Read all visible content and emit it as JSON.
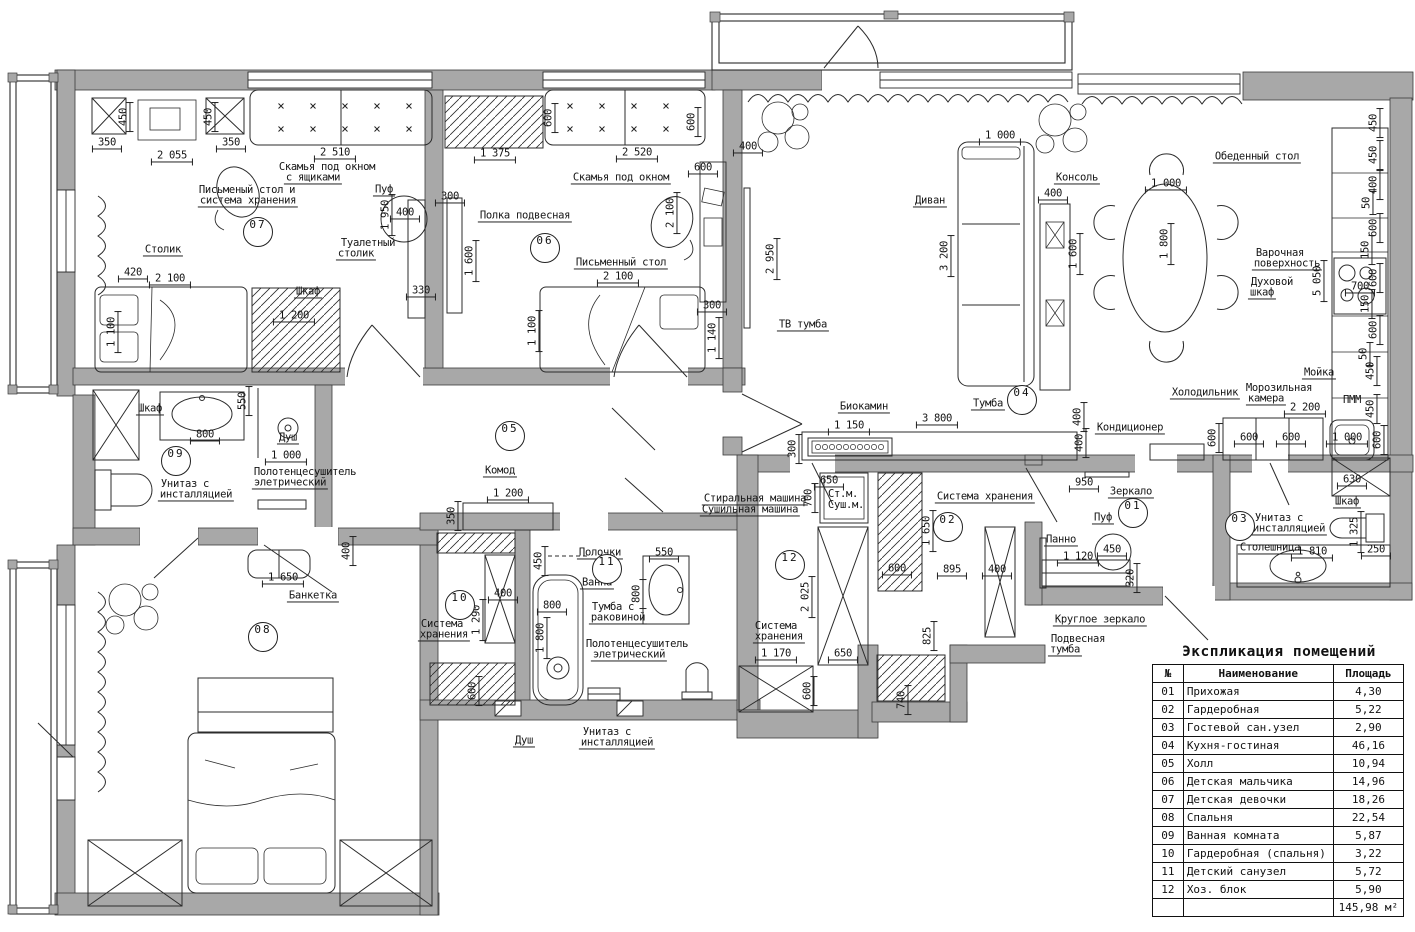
{
  "colors": {
    "wall": "#a8a8a8",
    "line": "#222222",
    "background": "#ffffff"
  },
  "legend": {
    "title": "Экспликация помещений",
    "col_no": "№",
    "col_name": "Наименование",
    "col_area": "Площадь",
    "rows": [
      [
        "01",
        "Прихожая",
        "4,30"
      ],
      [
        "02",
        "Гардеробная",
        "5,22"
      ],
      [
        "03",
        "Гостевой сан.узел",
        "2,90"
      ],
      [
        "04",
        "Кухня-гостиная",
        "46,16"
      ],
      [
        "05",
        "Холл",
        "10,94"
      ],
      [
        "06",
        "Детская мальчика",
        "14,96"
      ],
      [
        "07",
        "Детская девочки",
        "18,26"
      ],
      [
        "08",
        "Спальня",
        "22,54"
      ],
      [
        "09",
        "Ванная комната",
        "5,87"
      ],
      [
        "10",
        "Гардеробная (спальня)",
        "3,22"
      ],
      [
        "11",
        "Детский санузел",
        "5,72"
      ],
      [
        "12",
        "Хоз. блок",
        "5,90"
      ]
    ],
    "total": "145,98 м²"
  },
  "rooms": [
    {
      "n": "07",
      "x": 258,
      "y": 232
    },
    {
      "n": "06",
      "x": 545,
      "y": 248
    },
    {
      "n": "04",
      "x": 1022,
      "y": 400
    },
    {
      "n": "05",
      "x": 510,
      "y": 436
    },
    {
      "n": "09",
      "x": 176,
      "y": 461
    },
    {
      "n": "08",
      "x": 263,
      "y": 637
    },
    {
      "n": "10",
      "x": 460,
      "y": 605
    },
    {
      "n": "11",
      "x": 607,
      "y": 569
    },
    {
      "n": "12",
      "x": 790,
      "y": 565
    },
    {
      "n": "02",
      "x": 948,
      "y": 527
    },
    {
      "n": "01",
      "x": 1133,
      "y": 513
    },
    {
      "n": "03",
      "x": 1240,
      "y": 526
    }
  ],
  "plan": {
    "labels": [
      {
        "t": "350",
        "x": 107,
        "y": 143,
        "d": 1
      },
      {
        "t": "2 055",
        "x": 172,
        "y": 156,
        "d": 1
      },
      {
        "t": "350",
        "x": 231,
        "y": 143,
        "d": 1
      },
      {
        "t": "2 510",
        "x": 335,
        "y": 153,
        "d": 1
      },
      {
        "t": "450",
        "x": 124,
        "y": 117,
        "d": 1,
        "r": -90
      },
      {
        "t": "450",
        "x": 209,
        "y": 117,
        "d": 1,
        "r": -90
      },
      {
        "t": "1 950",
        "x": 386,
        "y": 215,
        "d": 1,
        "r": -90
      },
      {
        "t": "400",
        "x": 405,
        "y": 213,
        "d": 1
      },
      {
        "t": "420",
        "x": 133,
        "y": 273,
        "d": 1
      },
      {
        "t": "2 100",
        "x": 170,
        "y": 279,
        "d": 1
      },
      {
        "t": "1 200",
        "x": 294,
        "y": 316,
        "d": 1
      },
      {
        "t": "330",
        "x": 421,
        "y": 291,
        "d": 1
      },
      {
        "t": "1 100",
        "x": 112,
        "y": 332,
        "d": 1,
        "r": -90
      },
      {
        "t": "Скамья под окном",
        "x": 327,
        "y": 167
      },
      {
        "t": "с ящиками",
        "x": 313,
        "y": 178,
        "u": 1
      },
      {
        "t": "Письменый стол и",
        "x": 247,
        "y": 190
      },
      {
        "t": "система хранения",
        "x": 248,
        "y": 201,
        "u": 1
      },
      {
        "t": "Пуф",
        "x": 384,
        "y": 190,
        "u": 1
      },
      {
        "t": "Туалетный",
        "x": 368,
        "y": 243
      },
      {
        "t": "столик",
        "x": 356,
        "y": 254,
        "u": 1
      },
      {
        "t": "Столик",
        "x": 163,
        "y": 250,
        "u": 1
      },
      {
        "t": "Шкаф",
        "x": 308,
        "y": 292,
        "u": 1
      },
      {
        "t": "600",
        "x": 549,
        "y": 118,
        "d": 1,
        "r": -90
      },
      {
        "t": "600",
        "x": 692,
        "y": 122,
        "d": 1,
        "r": -90
      },
      {
        "t": "1 375",
        "x": 495,
        "y": 154,
        "d": 1
      },
      {
        "t": "2 520",
        "x": 637,
        "y": 153,
        "d": 1
      },
      {
        "t": "600",
        "x": 703,
        "y": 168,
        "d": 1
      },
      {
        "t": "300",
        "x": 450,
        "y": 197,
        "d": 1
      },
      {
        "t": "2 100",
        "x": 671,
        "y": 213,
        "d": 1,
        "r": -90
      },
      {
        "t": "1 600",
        "x": 470,
        "y": 261,
        "d": 1,
        "r": -90
      },
      {
        "t": "2 100",
        "x": 618,
        "y": 277,
        "d": 1
      },
      {
        "t": "1 100",
        "x": 533,
        "y": 331,
        "d": 1,
        "r": -90
      },
      {
        "t": "300",
        "x": 712,
        "y": 306,
        "d": 1
      },
      {
        "t": "1 140",
        "x": 713,
        "y": 338,
        "d": 1,
        "r": -90
      },
      {
        "t": "Скамья под окном",
        "x": 621,
        "y": 178,
        "u": 1
      },
      {
        "t": "Полка подвесная",
        "x": 525,
        "y": 216,
        "u": 1
      },
      {
        "t": "Письменный стол",
        "x": 621,
        "y": 263,
        "u": 1
      },
      {
        "t": "400",
        "x": 748,
        "y": 147,
        "d": 1
      },
      {
        "t": "2 950",
        "x": 771,
        "y": 259,
        "d": 1,
        "r": -90
      },
      {
        "t": "1 000",
        "x": 1000,
        "y": 136,
        "d": 1
      },
      {
        "t": "3 200",
        "x": 945,
        "y": 256,
        "d": 1,
        "r": -90
      },
      {
        "t": "400",
        "x": 1053,
        "y": 194,
        "d": 1
      },
      {
        "t": "1 600",
        "x": 1074,
        "y": 254,
        "d": 1,
        "r": -90
      },
      {
        "t": "1 000",
        "x": 1166,
        "y": 184,
        "d": 1
      },
      {
        "t": "1 800",
        "x": 1165,
        "y": 244,
        "d": 1,
        "r": -90
      },
      {
        "t": "5 050",
        "x": 1318,
        "y": 281,
        "d": 1,
        "r": -90
      },
      {
        "t": "700",
        "x": 1360,
        "y": 287,
        "d": 1
      },
      {
        "t": "450",
        "x": 1374,
        "y": 123,
        "d": 1,
        "r": -90
      },
      {
        "t": "450",
        "x": 1374,
        "y": 155,
        "d": 1,
        "r": -90
      },
      {
        "t": "400",
        "x": 1374,
        "y": 185,
        "d": 1,
        "r": -90
      },
      {
        "t": "50",
        "x": 1367,
        "y": 203,
        "d": 1,
        "r": -90
      },
      {
        "t": "600",
        "x": 1374,
        "y": 228,
        "d": 1,
        "r": -90
      },
      {
        "t": "150",
        "x": 1366,
        "y": 250,
        "d": 1,
        "r": -90
      },
      {
        "t": "600",
        "x": 1374,
        "y": 278,
        "d": 1,
        "r": -90
      },
      {
        "t": "150",
        "x": 1366,
        "y": 304,
        "d": 1,
        "r": -90
      },
      {
        "t": "600",
        "x": 1374,
        "y": 330,
        "d": 1,
        "r": -90
      },
      {
        "t": "50",
        "x": 1364,
        "y": 354,
        "d": 1,
        "r": -90
      },
      {
        "t": "450",
        "x": 1371,
        "y": 371,
        "d": 1,
        "r": -90
      },
      {
        "t": "450",
        "x": 1371,
        "y": 409,
        "d": 1,
        "r": -90
      },
      {
        "t": "600",
        "x": 1378,
        "y": 440,
        "d": 1,
        "r": -90
      },
      {
        "t": "2 200",
        "x": 1305,
        "y": 408,
        "d": 1
      },
      {
        "t": "600",
        "x": 1249,
        "y": 438,
        "d": 1
      },
      {
        "t": "600",
        "x": 1291,
        "y": 438,
        "d": 1
      },
      {
        "t": "1 000",
        "x": 1347,
        "y": 438,
        "d": 1
      },
      {
        "t": "600",
        "x": 1213,
        "y": 438,
        "d": 1,
        "r": -90
      },
      {
        "t": "400",
        "x": 1080,
        "y": 443,
        "d": 1,
        "r": -90
      },
      {
        "t": "3 800",
        "x": 937,
        "y": 419,
        "d": 1
      },
      {
        "t": "1 150",
        "x": 849,
        "y": 426,
        "d": 1
      },
      {
        "t": "300",
        "x": 793,
        "y": 449,
        "d": 1,
        "r": -90
      },
      {
        "t": "400",
        "x": 1078,
        "y": 417,
        "d": 1,
        "r": -90
      },
      {
        "t": "Диван",
        "x": 930,
        "y": 201,
        "u": 1
      },
      {
        "t": "Консоль",
        "x": 1077,
        "y": 178,
        "u": 1
      },
      {
        "t": "ТВ тумба",
        "x": 803,
        "y": 325,
        "u": 1
      },
      {
        "t": "Обеденный стол",
        "x": 1257,
        "y": 157,
        "u": 1
      },
      {
        "t": "Варочная",
        "x": 1280,
        "y": 253
      },
      {
        "t": "поверхность",
        "x": 1287,
        "y": 264,
        "u": 1
      },
      {
        "t": "Духовой",
        "x": 1272,
        "y": 282
      },
      {
        "t": "шкаф",
        "x": 1262,
        "y": 293,
        "u": 1
      },
      {
        "t": "Мойка",
        "x": 1319,
        "y": 373,
        "u": 1
      },
      {
        "t": "ПММ",
        "x": 1352,
        "y": 400
      },
      {
        "t": "Холодильник",
        "x": 1205,
        "y": 393,
        "u": 1
      },
      {
        "t": "Морозильная",
        "x": 1279,
        "y": 388
      },
      {
        "t": "камера",
        "x": 1266,
        "y": 399,
        "u": 1
      },
      {
        "t": "Кондиционер",
        "x": 1130,
        "y": 428,
        "u": 1
      },
      {
        "t": "Биокамин",
        "x": 864,
        "y": 407,
        "u": 1
      },
      {
        "t": "Тумба",
        "x": 988,
        "y": 404,
        "u": 1
      },
      {
        "t": "Комод",
        "x": 500,
        "y": 471,
        "u": 1
      },
      {
        "t": "1 200",
        "x": 508,
        "y": 494,
        "d": 1
      },
      {
        "t": "350",
        "x": 452,
        "y": 516,
        "d": 1,
        "r": -90
      },
      {
        "t": "1 650",
        "x": 283,
        "y": 578,
        "d": 1
      },
      {
        "t": "400",
        "x": 347,
        "y": 551,
        "d": 1,
        "r": -90
      },
      {
        "t": "Банкетка",
        "x": 313,
        "y": 596,
        "u": 1
      },
      {
        "t": "Шкаф",
        "x": 150,
        "y": 409,
        "u": 1
      },
      {
        "t": "550",
        "x": 243,
        "y": 401,
        "d": 1,
        "r": -90
      },
      {
        "t": "800",
        "x": 205,
        "y": 435,
        "d": 1
      },
      {
        "t": "Душ",
        "x": 288,
        "y": 438,
        "u": 1
      },
      {
        "t": "1 000",
        "x": 286,
        "y": 456,
        "d": 1
      },
      {
        "t": "Унитаз с",
        "x": 185,
        "y": 484
      },
      {
        "t": "инсталляцией",
        "x": 196,
        "y": 495,
        "u": 1
      },
      {
        "t": "Полотенцесушитель",
        "x": 305,
        "y": 472
      },
      {
        "t": "элетрический",
        "x": 290,
        "y": 483,
        "u": 1
      },
      {
        "t": "Полочки",
        "x": 600,
        "y": 553,
        "u": 1
      },
      {
        "t": "Ванна",
        "x": 597,
        "y": 583,
        "u": 1
      },
      {
        "t": "550",
        "x": 664,
        "y": 553,
        "d": 1
      },
      {
        "t": "800",
        "x": 637,
        "y": 594,
        "d": 1,
        "r": -90
      },
      {
        "t": "450",
        "x": 539,
        "y": 561,
        "d": 1,
        "r": -90
      },
      {
        "t": "800",
        "x": 552,
        "y": 606,
        "d": 1
      },
      {
        "t": "Тумба с",
        "x": 613,
        "y": 607
      },
      {
        "t": "раковиной",
        "x": 618,
        "y": 618,
        "u": 1
      },
      {
        "t": "400",
        "x": 503,
        "y": 594,
        "d": 1
      },
      {
        "t": "1 290",
        "x": 477,
        "y": 620,
        "d": 1,
        "r": -90
      },
      {
        "t": "Система",
        "x": 442,
        "y": 624
      },
      {
        "t": "хранения",
        "x": 444,
        "y": 635,
        "u": 1
      },
      {
        "t": "1 800",
        "x": 541,
        "y": 638,
        "d": 1,
        "r": -90
      },
      {
        "t": "Полотенцесушитель",
        "x": 637,
        "y": 644
      },
      {
        "t": "элетрический",
        "x": 629,
        "y": 655,
        "u": 1
      },
      {
        "t": "600",
        "x": 473,
        "y": 691,
        "d": 1,
        "r": -90
      },
      {
        "t": "Душ",
        "x": 524,
        "y": 741,
        "u": 1
      },
      {
        "t": "Унитаз с",
        "x": 607,
        "y": 732
      },
      {
        "t": "инсталляцией",
        "x": 617,
        "y": 743,
        "u": 1
      },
      {
        "t": "Стиральная машина",
        "x": 755,
        "y": 499,
        "u": 1
      },
      {
        "t": "Сушильная машина",
        "x": 750,
        "y": 510,
        "u": 1
      },
      {
        "t": "650",
        "x": 829,
        "y": 481,
        "d": 1
      },
      {
        "t": "700",
        "x": 809,
        "y": 498,
        "d": 1,
        "r": -90
      },
      {
        "t": "Ст.м.",
        "x": 843,
        "y": 494
      },
      {
        "t": "Суш.м.",
        "x": 846,
        "y": 505
      },
      {
        "t": "2 025",
        "x": 806,
        "y": 597,
        "d": 1,
        "r": -90
      },
      {
        "t": "Система",
        "x": 776,
        "y": 626
      },
      {
        "t": "хранения",
        "x": 779,
        "y": 637,
        "u": 1
      },
      {
        "t": "1 170",
        "x": 776,
        "y": 654,
        "d": 1
      },
      {
        "t": "650",
        "x": 843,
        "y": 654,
        "d": 1
      },
      {
        "t": "600",
        "x": 808,
        "y": 691,
        "d": 1,
        "r": -90
      },
      {
        "t": "Система хранения",
        "x": 985,
        "y": 497,
        "u": 1
      },
      {
        "t": "1 650",
        "x": 927,
        "y": 531,
        "d": 1,
        "r": -90
      },
      {
        "t": "600",
        "x": 897,
        "y": 569,
        "d": 1
      },
      {
        "t": "895",
        "x": 952,
        "y": 570,
        "d": 1
      },
      {
        "t": "400",
        "x": 997,
        "y": 570,
        "d": 1
      },
      {
        "t": "825",
        "x": 928,
        "y": 636,
        "d": 1,
        "r": -90
      },
      {
        "t": "740",
        "x": 902,
        "y": 700,
        "d": 1,
        "r": -90
      },
      {
        "t": "950",
        "x": 1084,
        "y": 483,
        "d": 1
      },
      {
        "t": "Зеркало",
        "x": 1131,
        "y": 492,
        "u": 1
      },
      {
        "t": "Пуф",
        "x": 1103,
        "y": 518,
        "u": 1
      },
      {
        "t": "Панно",
        "x": 1061,
        "y": 540,
        "u": 1
      },
      {
        "t": "450",
        "x": 1112,
        "y": 550,
        "d": 1
      },
      {
        "t": "1 120",
        "x": 1078,
        "y": 557,
        "d": 1
      },
      {
        "t": "320",
        "x": 1131,
        "y": 578,
        "d": 1,
        "r": -90
      },
      {
        "t": "Круглое зеркало",
        "x": 1100,
        "y": 620,
        "u": 1
      },
      {
        "t": "Подвесная",
        "x": 1078,
        "y": 639
      },
      {
        "t": "тумба",
        "x": 1065,
        "y": 650,
        "u": 1
      },
      {
        "t": "Унитаз с",
        "x": 1279,
        "y": 518
      },
      {
        "t": "инсталляцией",
        "x": 1289,
        "y": 529,
        "u": 1
      },
      {
        "t": "Шкаф",
        "x": 1347,
        "y": 502,
        "u": 1
      },
      {
        "t": "1 325",
        "x": 1355,
        "y": 532,
        "d": 1,
        "r": -90
      },
      {
        "t": "Столешница",
        "x": 1270,
        "y": 548,
        "u": 1
      },
      {
        "t": "1 810",
        "x": 1312,
        "y": 552,
        "d": 1
      },
      {
        "t": "250",
        "x": 1376,
        "y": 550,
        "d": 1
      },
      {
        "t": "630",
        "x": 1352,
        "y": 480,
        "d": 1
      }
    ]
  }
}
